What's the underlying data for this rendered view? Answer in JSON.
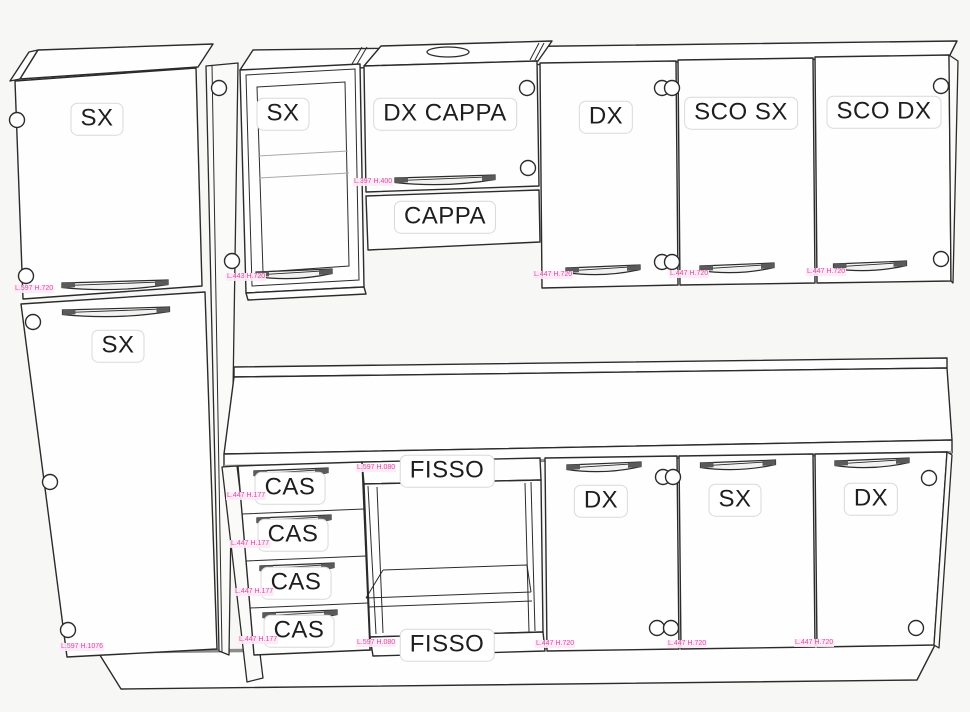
{
  "title": "Kitchen cabinet elevation diagram",
  "colors": {
    "background": "#f7f7f5",
    "line": "#2b2b2b",
    "dim_text": "#d84f9f",
    "chip_bg": "#ffffff",
    "chip_border": "#d9d9d6"
  },
  "labels": {
    "tall_upper": {
      "label": "SX",
      "dim": "L.597 H.720"
    },
    "tall_lower": {
      "label": "SX",
      "dim": "L.597 H.1076"
    },
    "wall_glass": {
      "label": "SX",
      "dim": "L.443 H.720"
    },
    "wall_hood_door": {
      "label": "DX CAPPA",
      "dim": "L.397 H.400"
    },
    "hood_panel": {
      "label": "CAPPA"
    },
    "wall_dx": {
      "label": "DX",
      "dim": "L.447 H.720"
    },
    "wall_sco_sx": {
      "label": "SCO SX",
      "dim": "L.447 H.720"
    },
    "wall_sco_dx": {
      "label": "SCO DX",
      "dim": "L.447 H.720"
    },
    "drawers": [
      {
        "label": "CAS",
        "dim": "L.447 H.177"
      },
      {
        "label": "CAS",
        "dim": "L.447 H.177"
      },
      {
        "label": "CAS",
        "dim": "L.447 H.177"
      },
      {
        "label": "CAS",
        "dim": "L.447 H.177"
      }
    ],
    "fixed_top": {
      "label": "FISSO",
      "dim": "L.597 H.080"
    },
    "fixed_bottom": {
      "label": "FISSO",
      "dim": "L.597 H.080"
    },
    "base_dx_left": {
      "label": "DX",
      "dim": "L.447 H.720"
    },
    "base_sx": {
      "label": "SX",
      "dim": "L.447 H.720"
    },
    "base_dx_right": {
      "label": "DX",
      "dim": "L.447 H.720"
    }
  }
}
